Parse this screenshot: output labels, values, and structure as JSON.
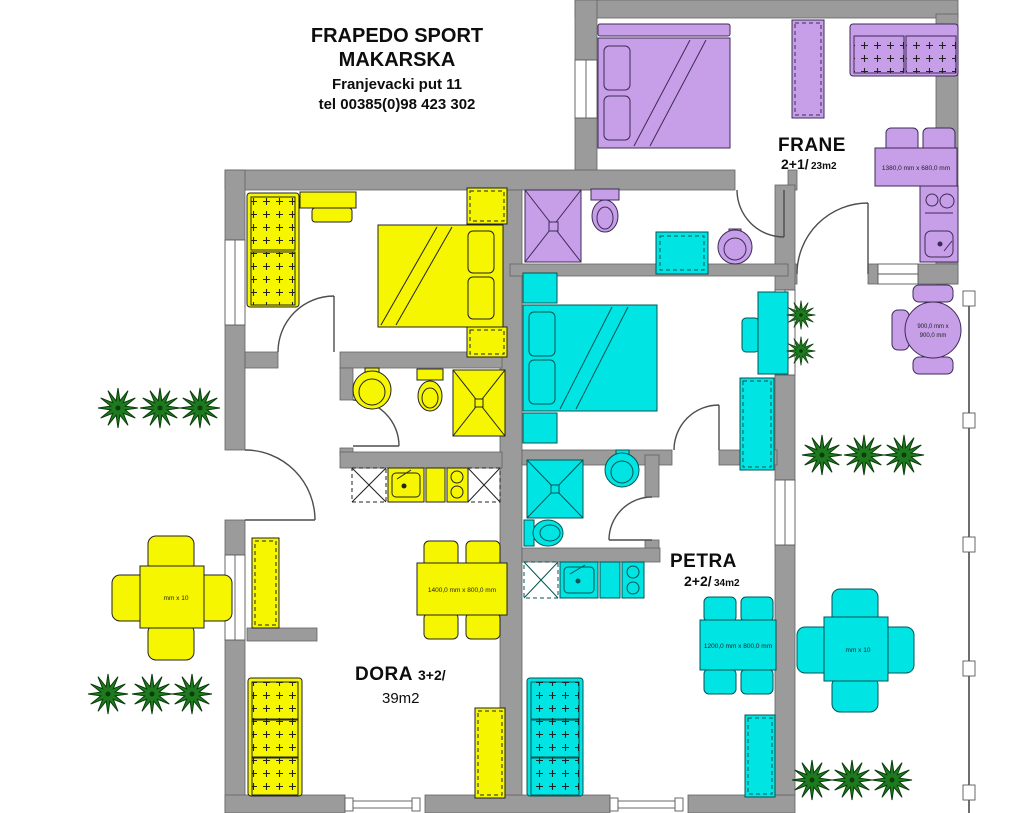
{
  "title": {
    "line1": "FRAPEDO SPORT",
    "line2": "MAKARSKA",
    "line3": "Franjevacki put 11",
    "line4": "tel 00385(0)98 423 302"
  },
  "apartments": {
    "frane": {
      "name": "FRANE",
      "capacity": "2+1/",
      "area": "23m2",
      "color": "#c79fe8",
      "dining_table_size": "1380,0 mm x 680,0 mm"
    },
    "dora": {
      "name": "DORA",
      "capacity": "3+2/",
      "area": "39m2",
      "color": "#f6f600",
      "dining_table_size": "1400,0 mm x 800,0 mm"
    },
    "petra": {
      "name": "PETRA",
      "capacity": "2+2/",
      "area": "34m2",
      "color": "#00e4e4",
      "dining_table_size": "1200,0 mm x 800,0 mm"
    }
  },
  "terrace": {
    "round_table_size_line1": "900,0 mm x",
    "round_table_size_line2": "900,0 mm",
    "yellow_square_table_size": "mm x 10",
    "cyan_square_table_size": "mm x 10"
  },
  "palette": {
    "wall": "#9b9b9b",
    "tree": "#1e7a1e",
    "appliance_cyan": "#00e4e4",
    "background": "#ffffff"
  }
}
